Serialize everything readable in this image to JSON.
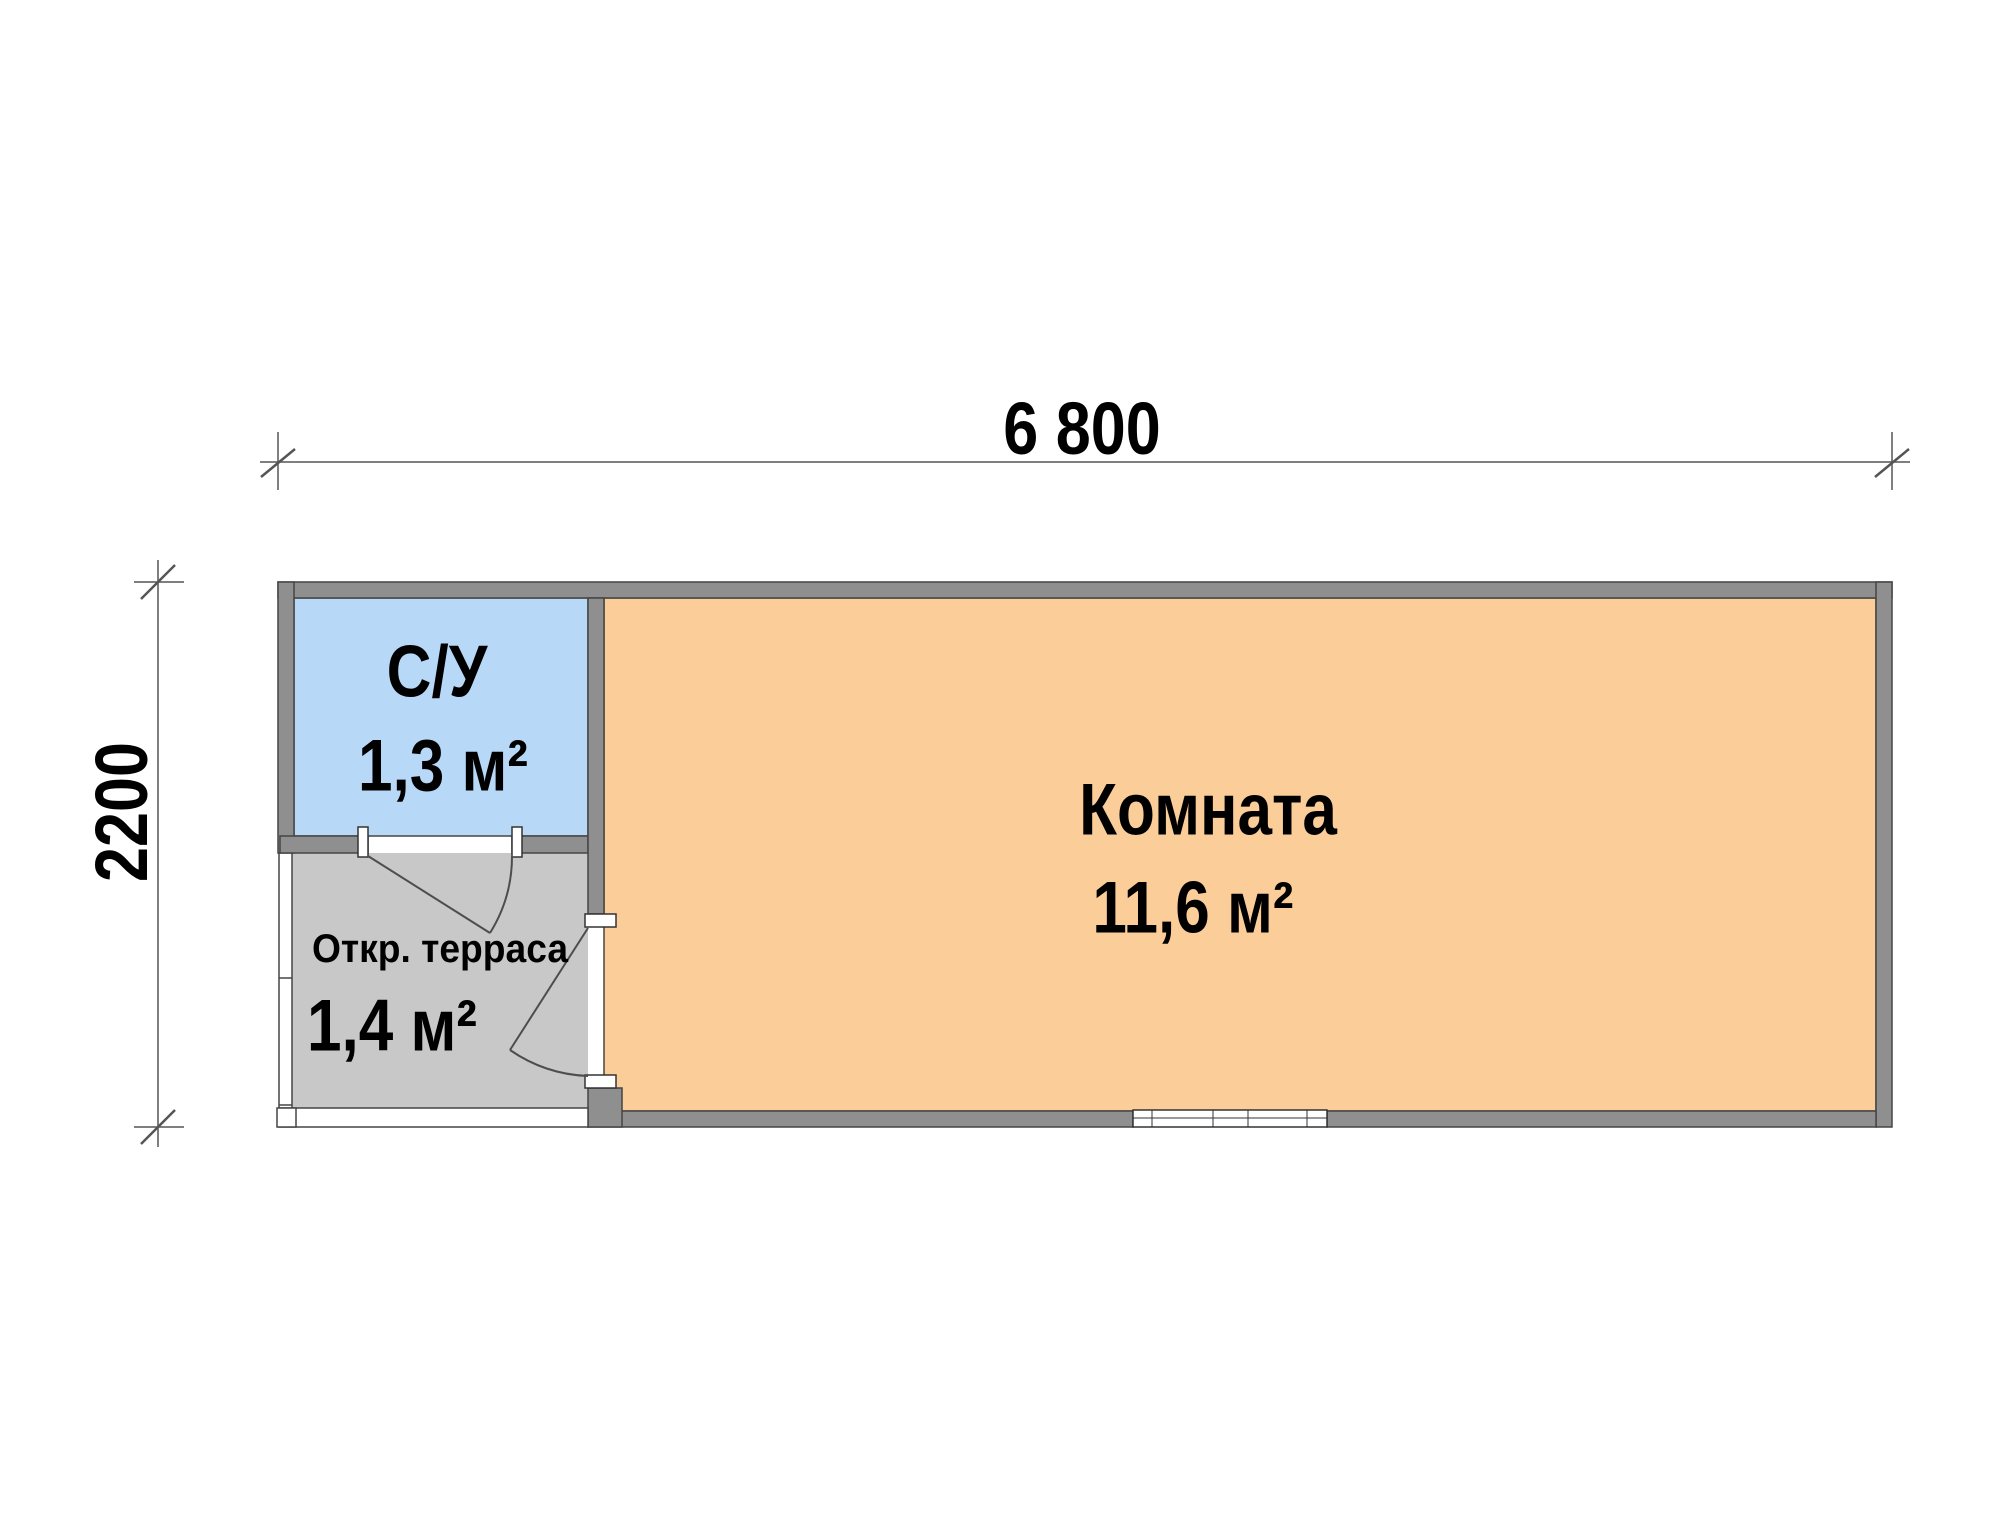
{
  "floor_plan": {
    "dimension_width_label": "6 800",
    "dimension_height_label": "2200",
    "rooms": [
      {
        "name": "С/У",
        "area": "1,3 м²"
      },
      {
        "name": "Комната",
        "area": "11,6 м²"
      },
      {
        "name": "Откр. терраса",
        "area": "1,4 м²"
      }
    ],
    "colors": {
      "bathroom_fill": "#b8d8f8",
      "room_fill": "#fbcd98",
      "terrace_fill": "#c8c8c8",
      "wall_fill": "#8f8f8f",
      "line_color": "#454545",
      "dim_color": "#555555"
    }
  }
}
